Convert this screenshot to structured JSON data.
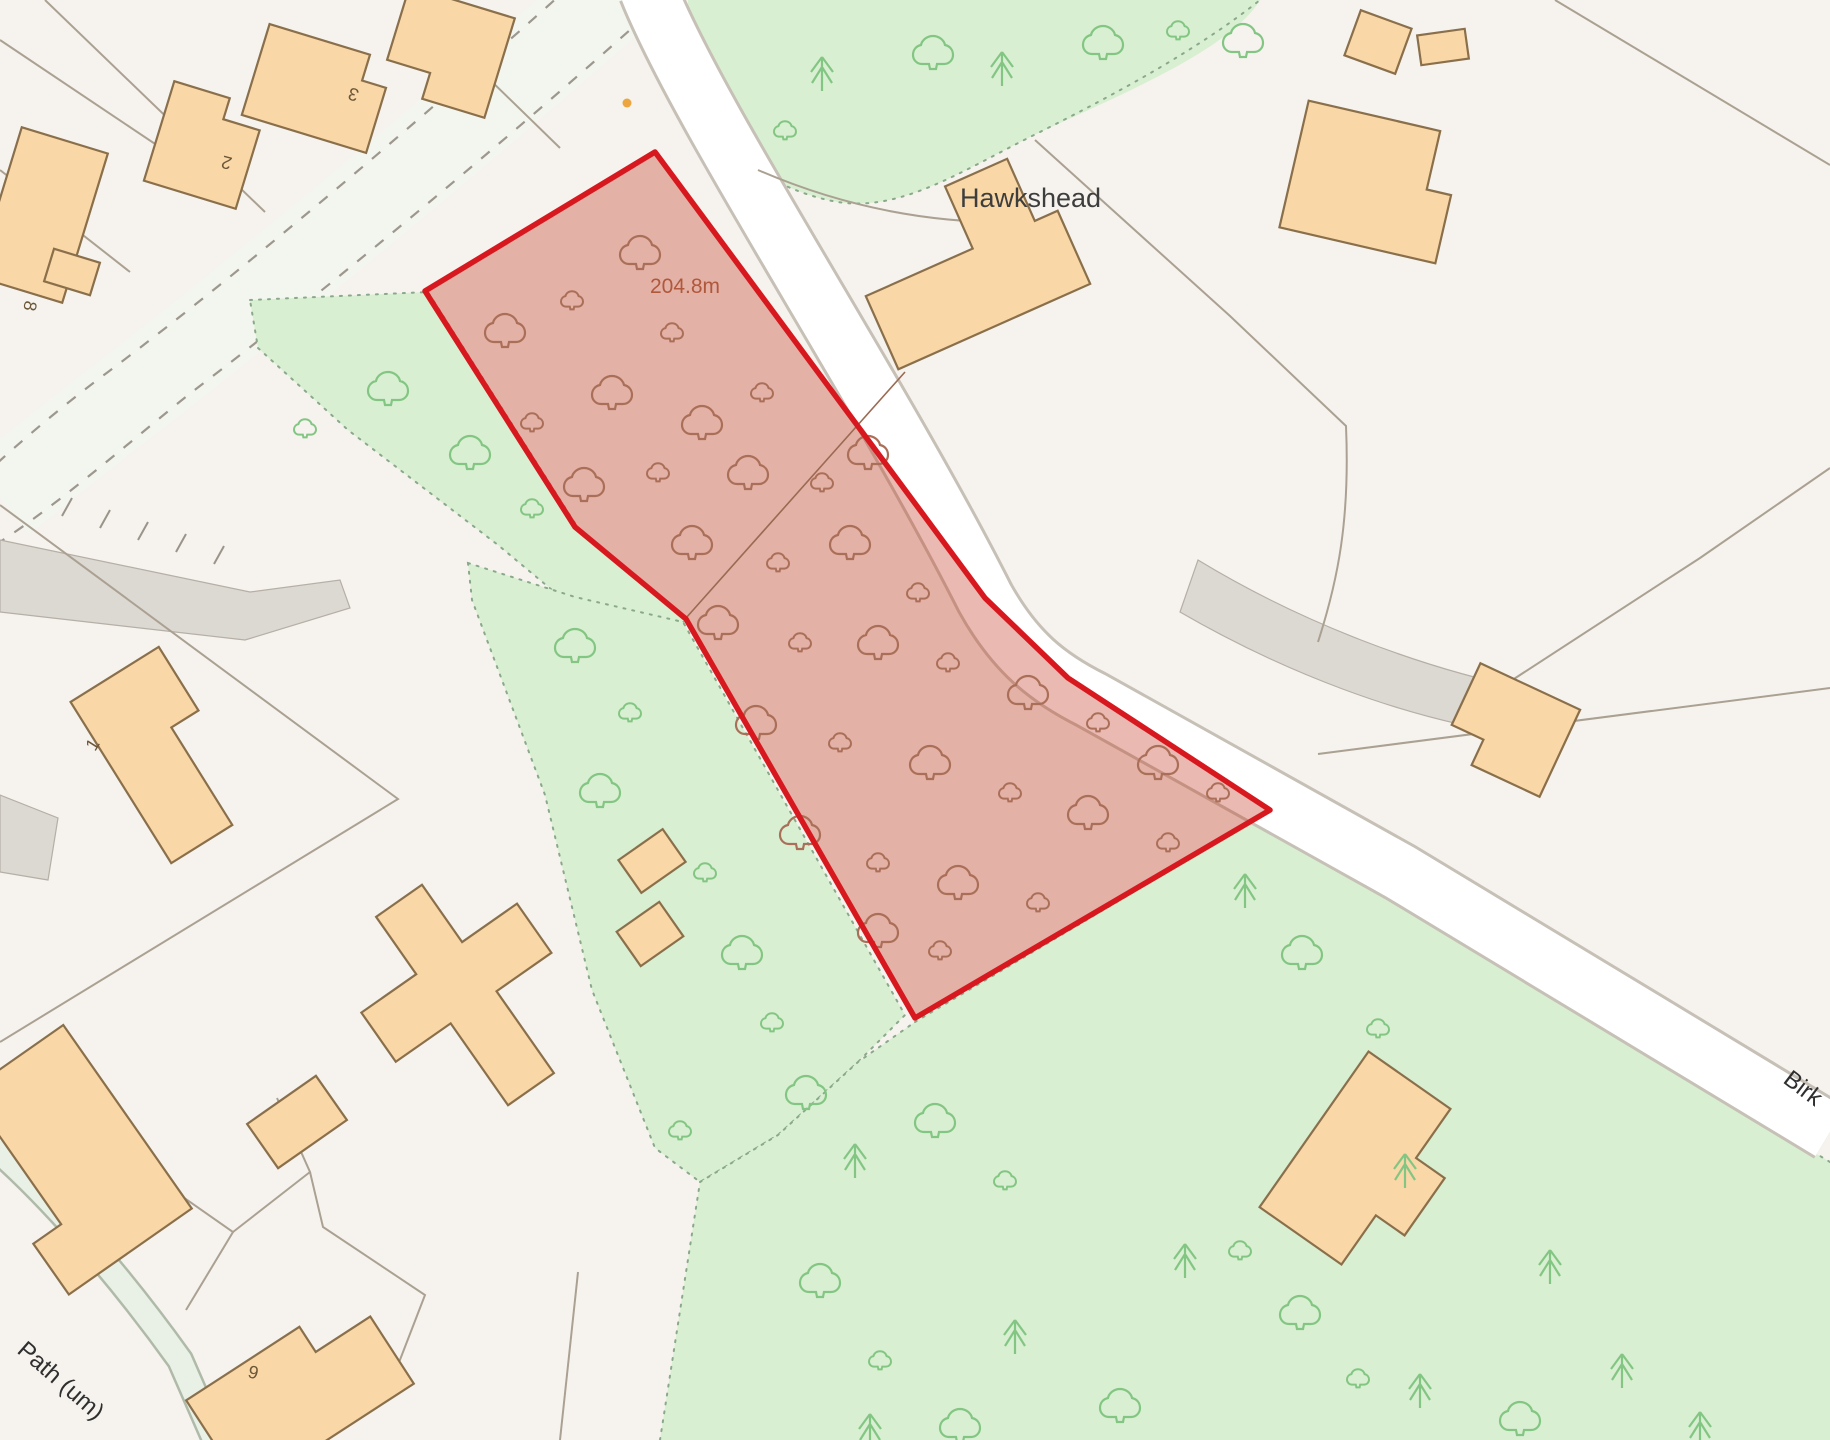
{
  "map": {
    "labels": {
      "place": "Hawkshead",
      "spot_height": "204.8m",
      "path": "Path (um)",
      "road_partial": "Birk",
      "house_number_3": "3",
      "house_number_2": "2",
      "house_number_8": "8",
      "house_number_1": "1",
      "house_number_9": "9"
    },
    "plot": {
      "boundary_color": "#d7191f",
      "fill_color": "rgba(197,62,40,0.36)"
    },
    "colors": {
      "background": "#f6f3ee",
      "building_fill": "#f9d7a7",
      "building_stroke": "#8a6f4b",
      "woodland_fill": "#d9efd2",
      "tree_green": "#83c683",
      "tree_in_plot": "#aa6f58",
      "road_fill": "#ffffff",
      "road_casing": "#c6c0b6",
      "gray_surface": "#dcd8d2",
      "parcel_line": "#aaa192",
      "spot_height_text": "#b0583b",
      "label_text": "#2f2f2f",
      "marker_dot": "#eda53f"
    }
  }
}
